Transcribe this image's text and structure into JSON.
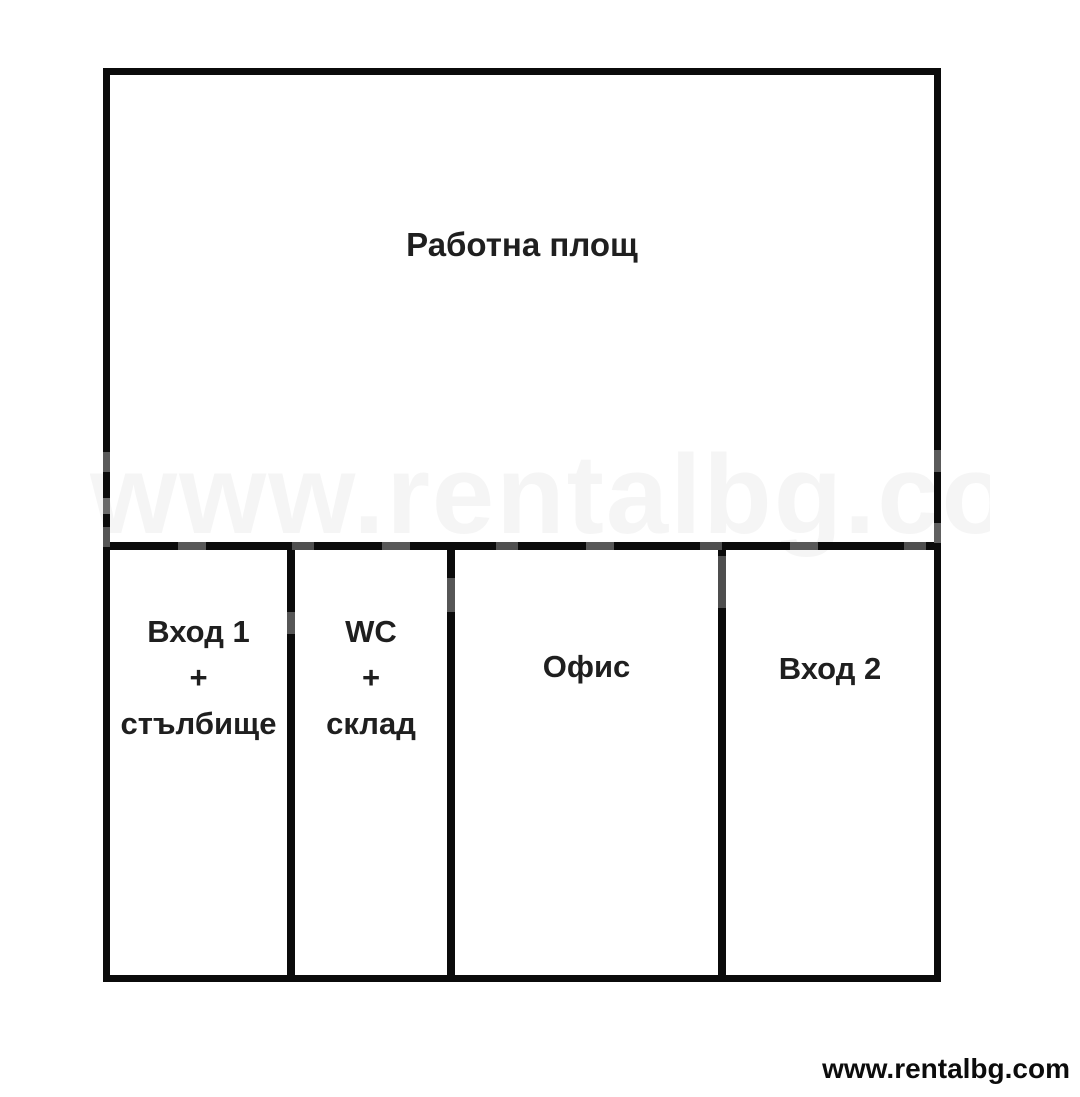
{
  "plan": {
    "rooms": [
      {
        "name": "work-area",
        "label": "Работна площ"
      },
      {
        "name": "entrance-1-staircase",
        "label": "Вход 1\n+\nстълбище"
      },
      {
        "name": "wc-storage",
        "label": "WC\n+\nсклад"
      },
      {
        "name": "office",
        "label": "Офис"
      },
      {
        "name": "entrance-2",
        "label": "Вход 2"
      }
    ]
  },
  "watermark": {
    "faint_text": "www.rentalbg.com",
    "footer_text": "www.rentalbg.com"
  },
  "colors": {
    "wall": "#0b0b0b",
    "text": "#1f1f1f",
    "background": "#ffffff"
  }
}
